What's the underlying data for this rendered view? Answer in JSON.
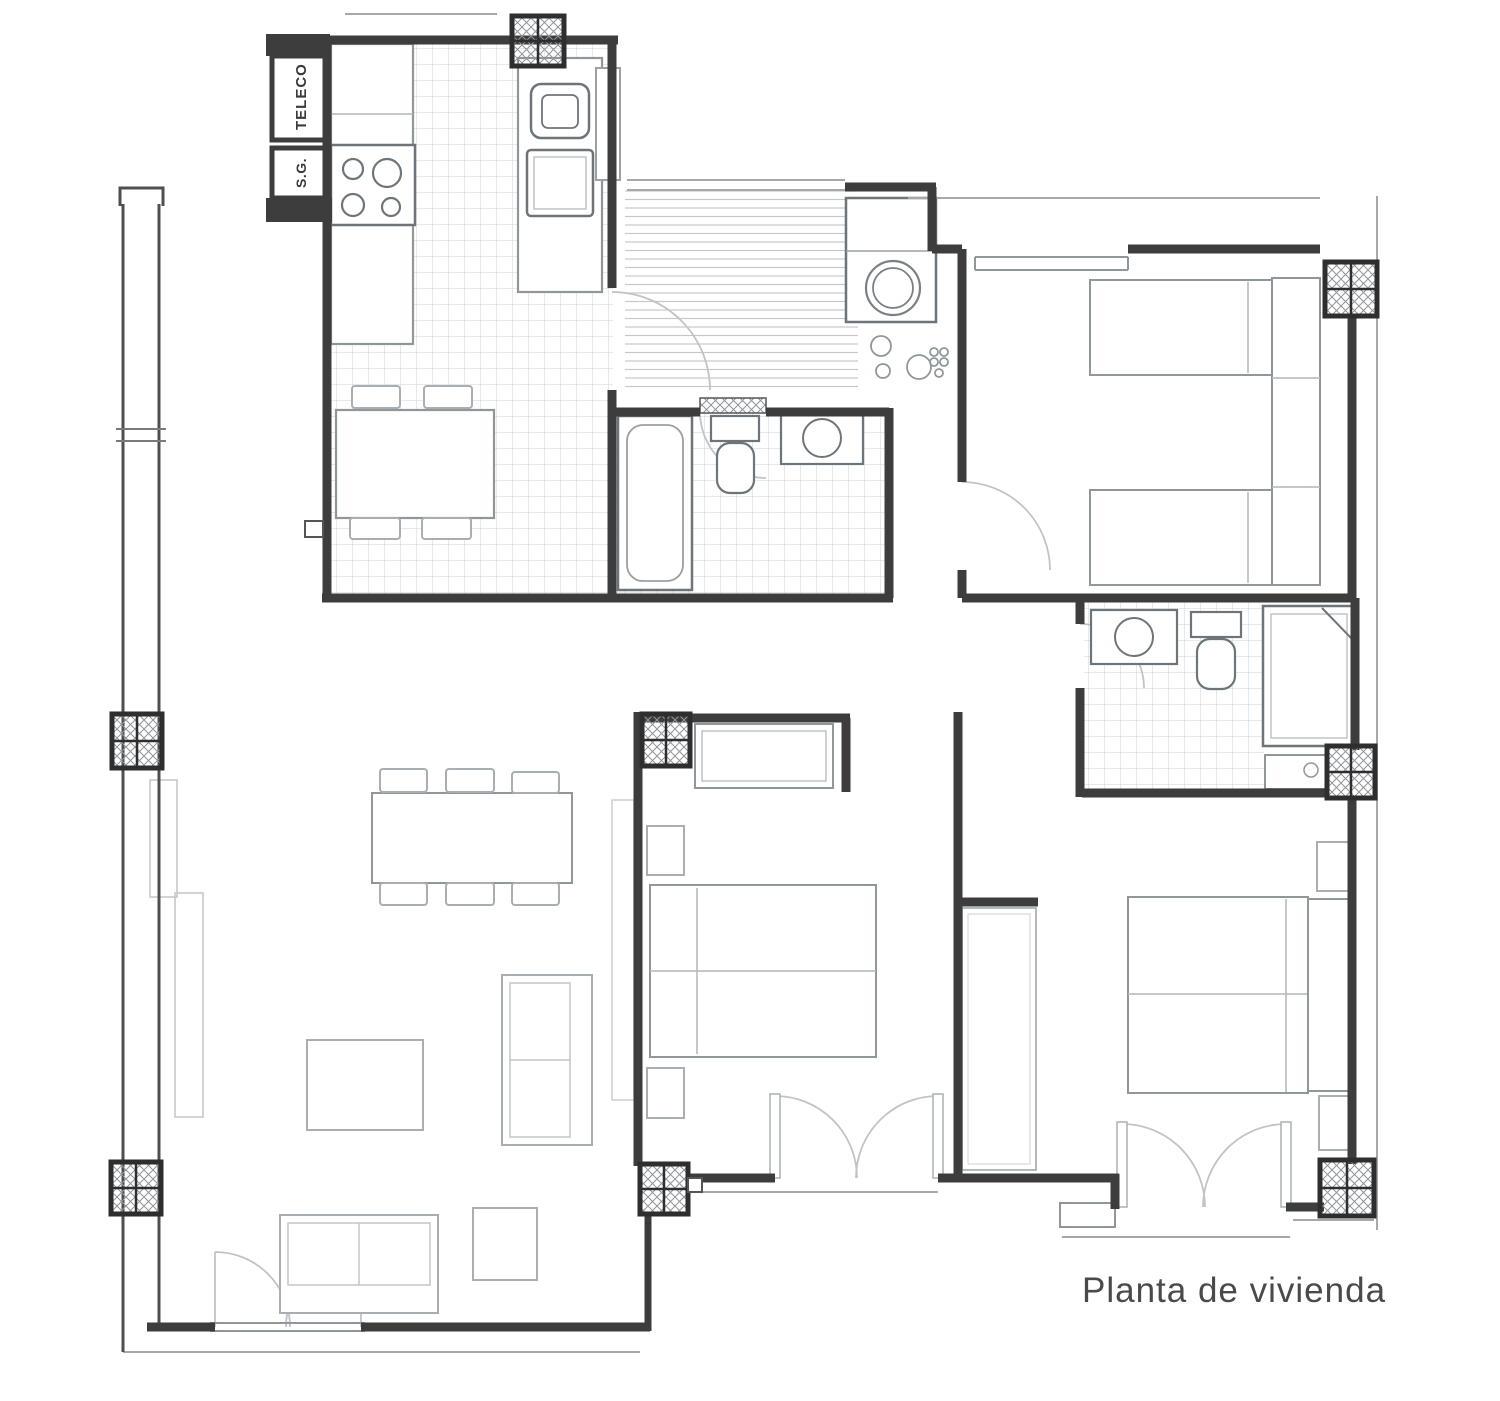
{
  "plan": {
    "caption": "Planta de vivienda",
    "labels": {
      "teleco_cabinet": "TELECO",
      "sg_cabinet": "S.G."
    },
    "colors": {
      "background": "#ffffff",
      "wall": "#3d3d3d",
      "wall_medium": "#5a5a5a",
      "furniture": "#8f979b",
      "furniture_light": "#aab0b4",
      "tile_grid": "#ccd1d3",
      "floor_stripes": "#c4c8ca",
      "pillar_hatch": "#8f959a",
      "door_arc": "#c0c4c6",
      "caption_text": "#4a4a4a"
    }
  }
}
